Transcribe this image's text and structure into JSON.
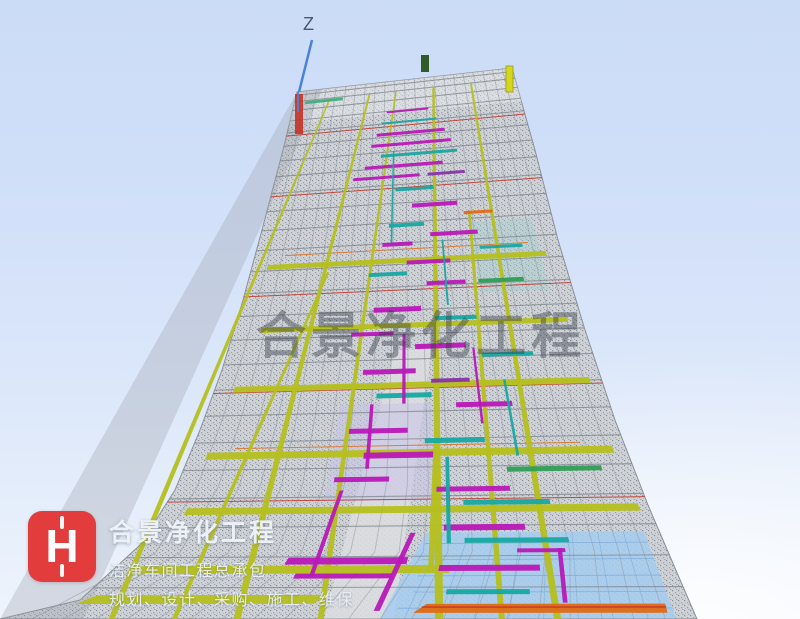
{
  "axis": {
    "label": "Z"
  },
  "watermark": {
    "text": "合景净化工程"
  },
  "branding": {
    "logo_letter": "H",
    "company_name": "合景净化工程",
    "tagline1": "洁净车间工程总承包",
    "tagline2": "规划、设计、采购、施工、维保"
  },
  "palette": {
    "axis": "#4a82d8",
    "logoRed": "#e23c3c",
    "wm": "rgba(52,58,70,0.42)",
    "trussBase": "#cfd3d8",
    "trussDot": "#878d95",
    "rowGray": "#7b818a",
    "fanGray": "#8d939b",
    "beam": "#b5bf1e",
    "beamDark": "#8d961a",
    "mag": "#b818b8",
    "teal": "#17a8a2",
    "green": "#2f9e54",
    "orange": "#df6a14",
    "purple": "#8833aa",
    "red": "#c33327",
    "blueFloor": "#a6ccf1",
    "blueFloorLine": "#79a6d4",
    "lavender": "#c8c5e6",
    "corridor": "#dcdde0"
  }
}
